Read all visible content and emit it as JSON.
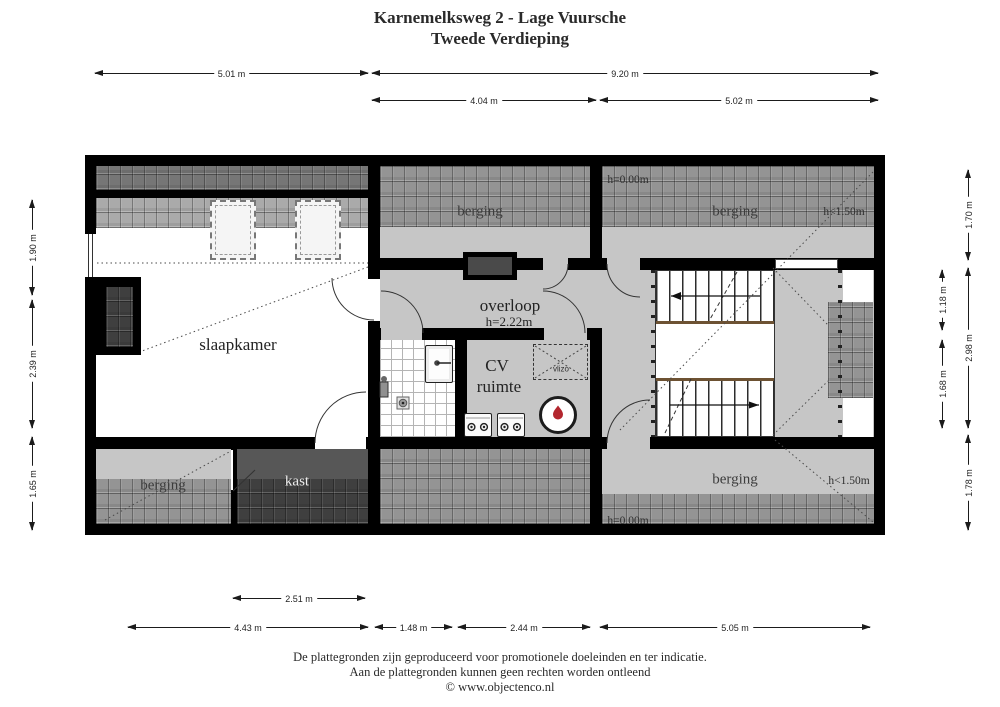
{
  "title": {
    "line1": "Karnemelksweg 2 - Lage Vuursche",
    "line2": "Tweede Verdieping"
  },
  "plan": {
    "labels": {
      "berging_top_middle": "berging",
      "berging_top_right": "berging",
      "berging_bottom_left": "berging",
      "berging_bottom_right": "berging",
      "slaapkamer": "slaapkamer",
      "overloop": "overloop",
      "overloop_height": "h=2.22m",
      "cv_line1": "CV",
      "cv_line2": "ruimte",
      "kast": "kast",
      "vlizo_hatch": "vlizo",
      "height_zero_top": "h=0.00m",
      "height_low_top": "h<1.50m",
      "height_low_bottom": "h<1.50m",
      "height_zero_bottom": "h=0.00m"
    },
    "colors": {
      "wall": "#000000",
      "floor_light": "#c6c6c6",
      "roof_tiles": "#949494",
      "roof_tiles_dark": "#767676",
      "kast_dark": "#3f3f3f",
      "stair_nosing": "#6d5233",
      "boiler_flame": "#b3262e"
    }
  },
  "dimensions": {
    "top": {
      "w1": "5.01 m",
      "w2": "9.20 m",
      "w3": "4.04 m",
      "w4": "5.02 m"
    },
    "bottom": {
      "w1": "2.51 m",
      "w2": "4.43 m",
      "w3": "1.48 m",
      "w4": "2.44 m",
      "w5": "5.05 m"
    },
    "left": {
      "h1": "1.90 m",
      "h2": "2.39 m",
      "h3": "1.65 m"
    },
    "right": {
      "h1": "1.70 m",
      "h2": "1.18 m",
      "h3": "2.98 m",
      "h4": "1.68 m",
      "h5": "1.78 m"
    }
  },
  "footer": {
    "line1": "De plattegronden zijn geproduceerd voor promotionele doeleinden en ter indicatie.",
    "line2": "Aan de plattegronden kunnen geen rechten worden ontleend",
    "line3": "© www.objectenco.nl"
  }
}
